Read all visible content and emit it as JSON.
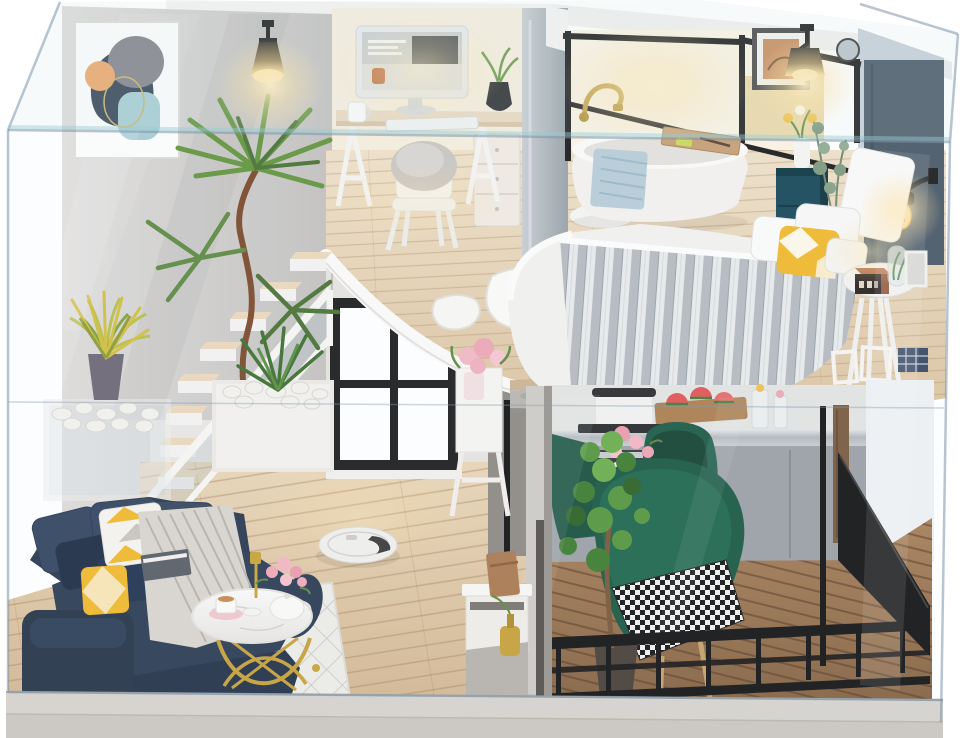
{
  "image": {
    "kind": "product-photo",
    "subject": "DIY miniature dollhouse: modern two-story loft apartment kit with LED lights, displayed inside a clear acrylic dust cover",
    "background_color": "#ffffff"
  },
  "regions": {
    "display_case": {
      "label": "Clear acrylic display case"
    },
    "loft_office": {
      "label": "Loft home office with computer desk and chair"
    },
    "bathroom": {
      "label": "Loft bathroom with freestanding tub behind black-framed glass"
    },
    "bedroom": {
      "label": "Loft bedroom with knit throw bed, sconce lamps and nightstand"
    },
    "staircase": {
      "label": "Floating staircase with white railing and pebble planters"
    },
    "living_room": {
      "label": "Living room with navy sofa, gold coffee table and robot vacuum"
    },
    "dining_balcony": {
      "label": "Balcony dining nook with green velvet chairs and round table"
    },
    "kitchen": {
      "label": "Kitchenette with cooktop, oven and watermelon board"
    },
    "base": {
      "label": "Gray display base board"
    }
  },
  "palette": {
    "accent_gold": "#c8a23c",
    "sofa_navy": "#2c3d54",
    "pillow_yellow": "#f1b82e",
    "chair_green": "#1b5a44",
    "dresser_teal": "#18495a",
    "railing_black": "#151515",
    "headboard_wall": "#4b5a68",
    "wall_gray": "#cbc9c8",
    "wall_warm": "#f6eedd",
    "wood_floor": "#dcc0a0",
    "loft_wood": "#e6d3b7",
    "deck_wood": "#9c7753",
    "blanket_gray": "#b5bbbf",
    "towel_blue": "#b7cdd8",
    "rose_pink": "#f0a8b8",
    "watermelon_red": "#e25555",
    "plant_green": "#5d8a42",
    "lamp_glow": "#ffe6ad",
    "case_tint": "#cddde6",
    "base_gray": "#d7d3ce"
  }
}
